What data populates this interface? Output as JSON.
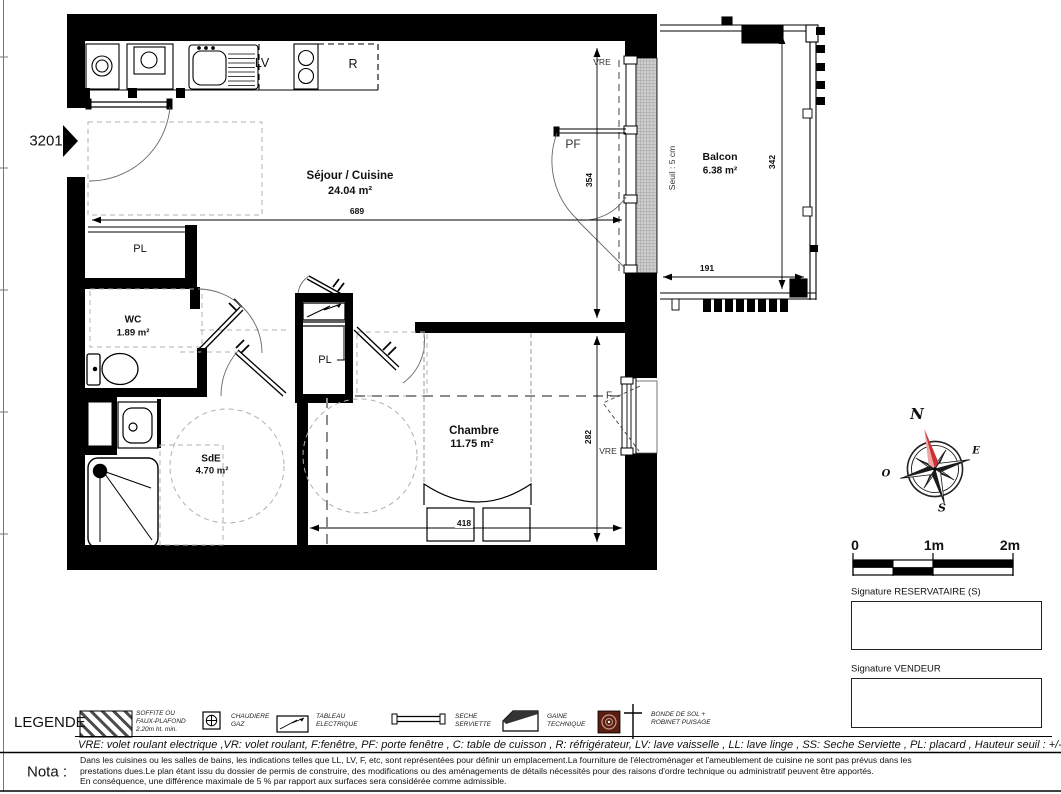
{
  "colors": {
    "wall": "#000000",
    "compass_red": "#d23030",
    "compass_pink": "#efa6a6",
    "bonde_maroon": "#5a1d12"
  },
  "plan": {
    "unit_number": "3201",
    "rooms": {
      "sejour": {
        "name": "Séjour / Cuisine",
        "area": "24.04 m²"
      },
      "wc": {
        "name": "WC",
        "area": "1.89 m²"
      },
      "sde": {
        "name": "SdE",
        "area": "4.70 m²"
      },
      "chambre": {
        "name": "Chambre",
        "area": "11.75 m²"
      },
      "balcon": {
        "name": "Balcon",
        "area": "6.38 m²"
      }
    },
    "closet1": "PL",
    "closet2": "PL",
    "appliances": {
      "lv": "LV",
      "r": "R"
    },
    "dims": {
      "sejour_w": "689",
      "sejour_h": "354",
      "chambre_h": "282",
      "chambre_w": "418",
      "balcon_w": "191",
      "balcon_h": "342"
    },
    "seuil": "Seuil : 5 cm",
    "openings": {
      "vre_top": "VRE",
      "pf": "PF",
      "f": "F",
      "vre_right": "VRE"
    }
  },
  "compass": {
    "n": "N",
    "e": "E",
    "s": "S",
    "o": "O"
  },
  "scalebar": {
    "t0": "0",
    "t1": "1m",
    "t2": "2m"
  },
  "signatures": {
    "reservataire": "Signature RESERVATAIRE (S)",
    "vendeur": "Signature VENDEUR"
  },
  "legend": {
    "title": "LEGENDE",
    "soffite": "SOFFITE OU\nFAUX-PLAFOND\n2.20m ht. min.",
    "chaudiere": "CHAUDIERE\nGAZ",
    "tableau": "TABLEAU\nELECTRIQUE",
    "seche": "SECHE\nSERVIETTE",
    "gaine": "GAINE\nTECHNIQUE",
    "bonde": "BONDE DE SOL +\nROBINET PUISAGE",
    "abbreviations": "VRE: volet roulant electrique ,VR: volet roulant, F:fenêtre, PF: porte fenêtre , C: table de cuisson , R: réfrigérateur, LV: lave vaisselle , LL: lave linge , SS: Seche Serviette , PL: placard , Hauteur seuil : +/- variable"
  },
  "nota": {
    "label": "Nota :",
    "line1": "Dans les cuisines ou les salles de bains, les indications telles que LL, LV, F, etc, sont représentées pour définir un emplacement.La fourniture de l'électroménager et l'ameublement de cuisine ne sont pas prévus dans les",
    "line2": "prestations dues.Le plan étant issu du dossier de permis de construire, des modifications ou des aménagements de détails nécessités pour des raisons d'ordre technique ou administratif peuvent être apportés.",
    "line3": "En conséquence, une différence maximale de 5 % par rapport aux surfaces sera considérée comme admissible."
  }
}
